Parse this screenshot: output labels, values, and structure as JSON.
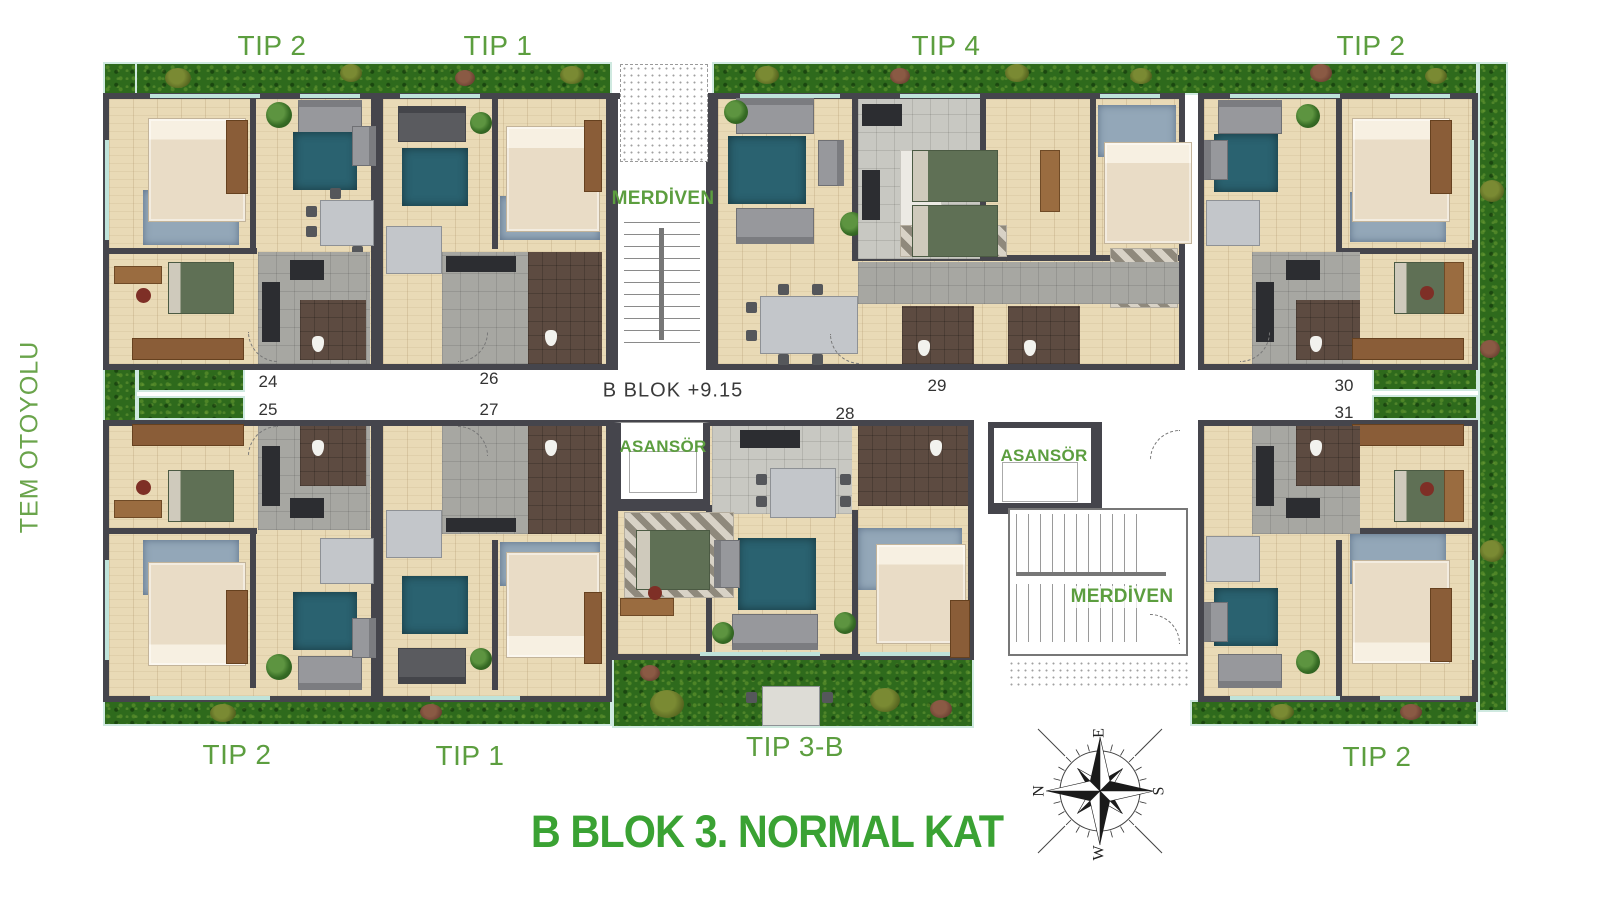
{
  "page": {
    "title_label": "B BLOK 3. NORMAL KAT",
    "road_label": "TEM OTOYOLU",
    "level_label": "B BLOK +9.15"
  },
  "unit_labels": {
    "top": [
      "TIP 2",
      "TIP 1",
      "TIP 4",
      "TIP 2"
    ],
    "bottom": [
      "TIP 2",
      "TIP 1",
      "TIP 3-B",
      "TIP 2"
    ]
  },
  "core_labels": {
    "stairs_top": "MERDİVEN",
    "stairs_bottom": "MERDİVEN",
    "elevator_left": "ASANSÖR",
    "elevator_right": "ASANSÖR"
  },
  "apartment_numbers": {
    "no24": "24",
    "no25": "25",
    "no26": "26",
    "no27": "27",
    "no28": "28",
    "no29": "29",
    "no30": "30",
    "no31": "31"
  },
  "compass": {
    "north": "N",
    "east": "E",
    "south": "S",
    "west": "W"
  },
  "colors": {
    "label_green": "#5c9e3f",
    "title_green": "#3aa233",
    "road_green": "#6aa44b",
    "grass": "#2e6a1c",
    "wall": "#45454c",
    "wood": "#e9dab6",
    "window": "#bfe3da",
    "rug": "#2a6270"
  }
}
